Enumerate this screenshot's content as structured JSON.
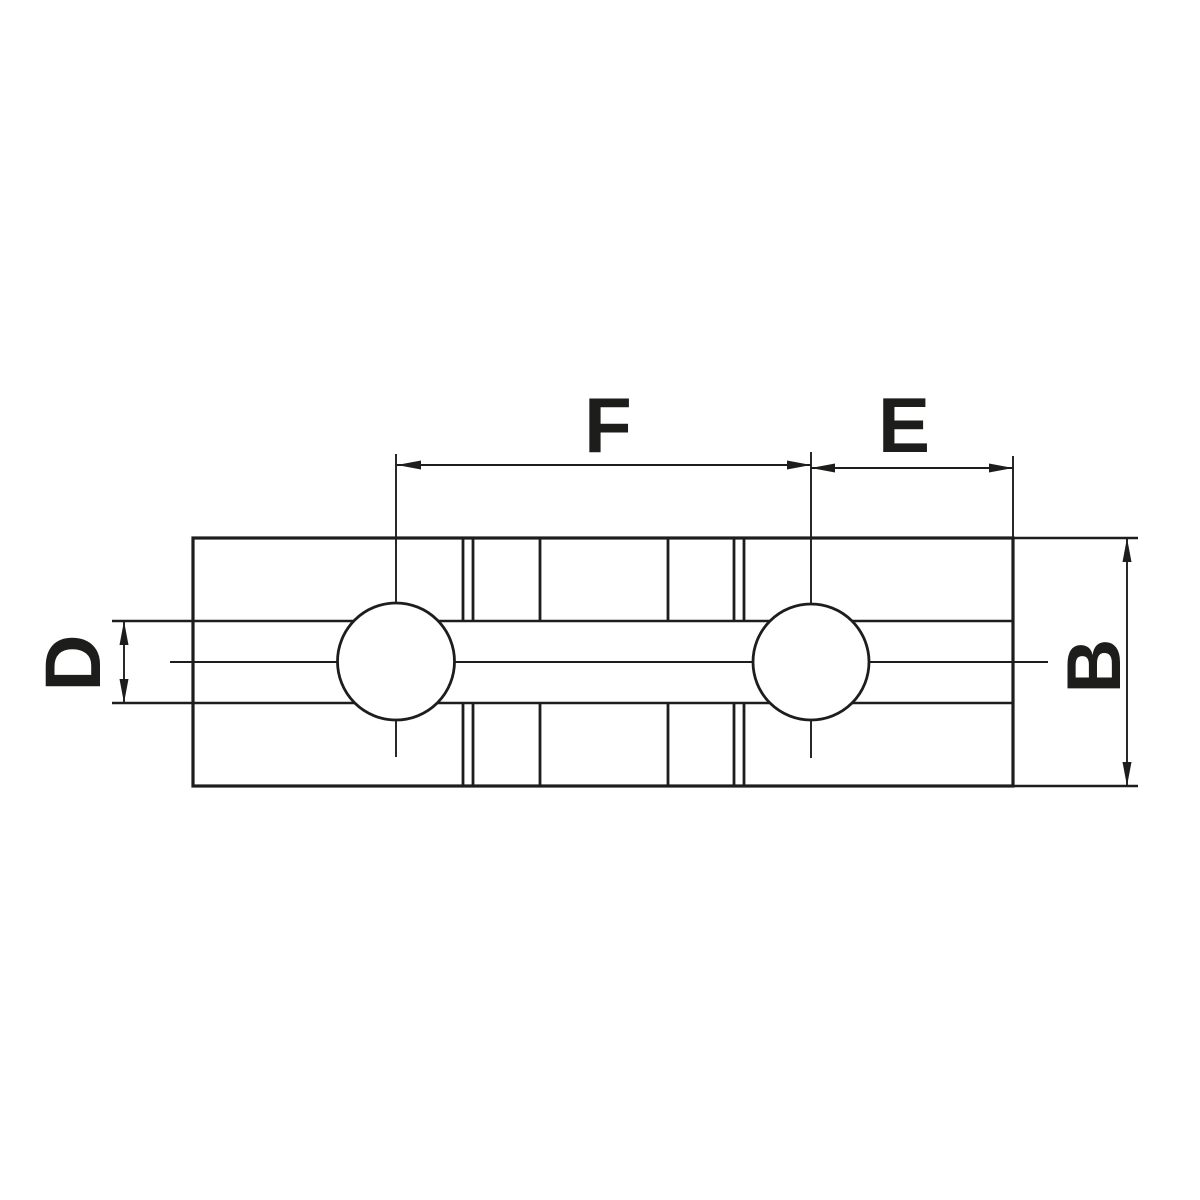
{
  "diagram": {
    "labels": {
      "top_span": "F",
      "top_right_span": "E",
      "left_height": "D",
      "right_height": "B"
    },
    "colors": {
      "line": "#1d1d1b",
      "background": "#ffffff"
    }
  }
}
